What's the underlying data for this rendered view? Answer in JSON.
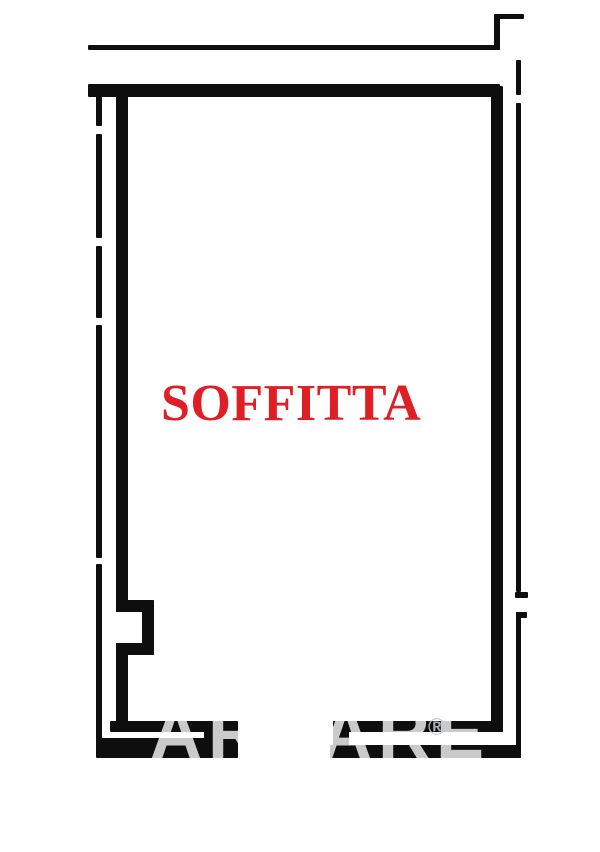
{
  "page": {
    "background_color": "#ffffff",
    "width_px": 600,
    "height_px": 852
  },
  "floor_plan": {
    "room_label": "SOFFITTA",
    "room_label_color": "#de2026",
    "wall_color": "#0e0e0e",
    "watermark": {
      "fragment_left": "AR",
      "fragment_right": "ARE",
      "registered_symbol": "®",
      "color": "rgba(255,255,255,0.78)"
    }
  }
}
